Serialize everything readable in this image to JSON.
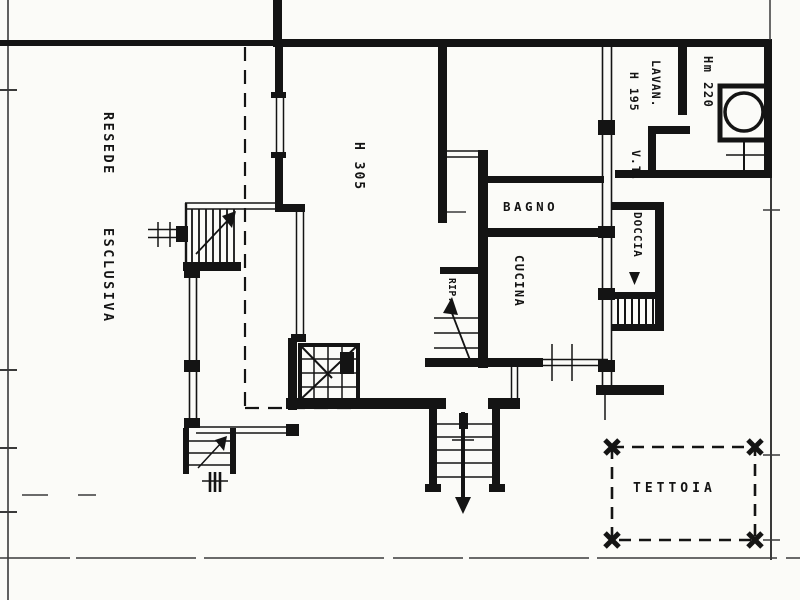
{
  "colors": {
    "ink": "#141414",
    "paper": "#fbfbf8"
  },
  "plan": {
    "area_labels": {
      "resede": "RESEDE",
      "esclusiva": "ESCLUSIVA"
    },
    "room_labels": {
      "main_room_height": "H 305",
      "bagno": "BAGNO",
      "cucina": "CUCINA",
      "ripostiglio": "RIP.",
      "lavanderia": "LAVAN.",
      "lavanderia_height": "H 195",
      "vt": "V.T.",
      "annex_height": "Hm 220",
      "doccia": "DOCCIA",
      "tettoia": "TETTOIA"
    }
  }
}
